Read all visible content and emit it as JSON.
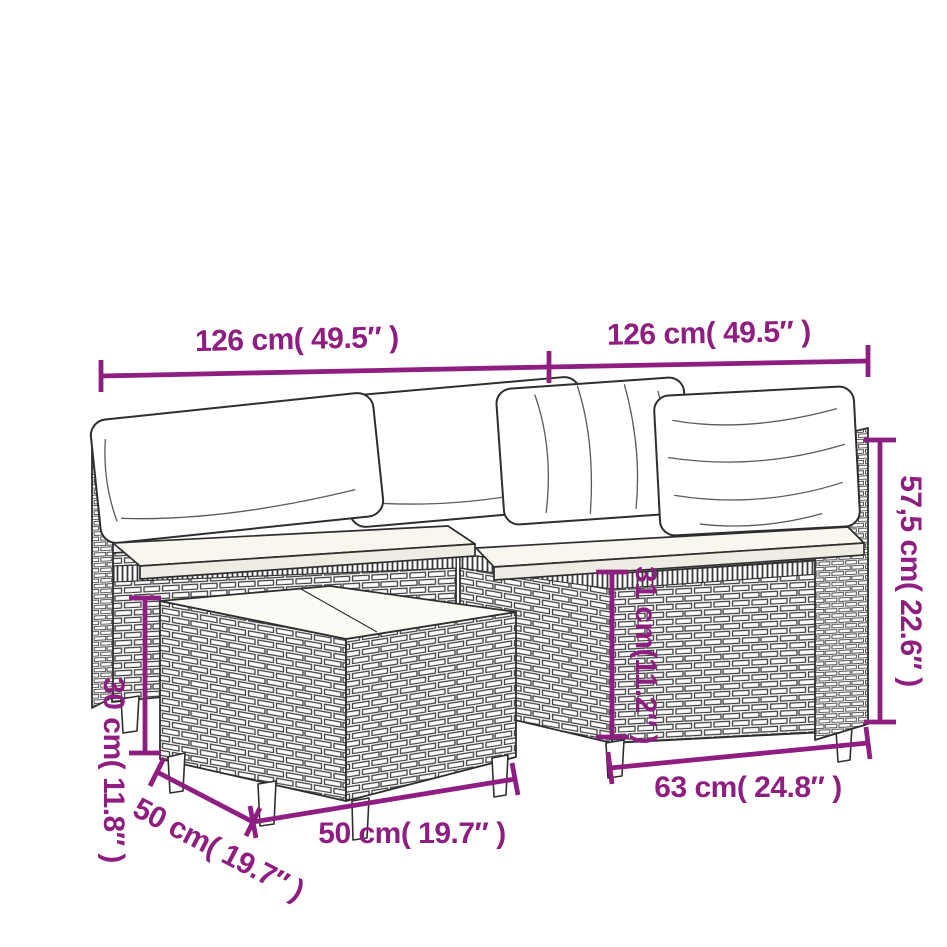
{
  "figure": {
    "description": "Line-art dimension diagram of a poly rattan garden corner sofa set with back pillows, seat cushions and a coffee table"
  },
  "colors": {
    "dimension_accent": "#8e1e80",
    "line_art": "#2e2e2e",
    "background": "#ffffff"
  },
  "dimensions": {
    "sofa_left_width": "126 cm( 49.5″ )",
    "sofa_right_width": "126 cm( 49.5″ )",
    "back_height": "57,5 cm( 22.6″ )",
    "seat_height": "31 cm(11.2″ )",
    "table_height": "30 cm( 11.8″ )",
    "table_depth": "50 cm( 19.7″ )",
    "table_width": "50 cm( 19.7″ )",
    "seat_depth": "63 cm( 24.8″ )"
  }
}
